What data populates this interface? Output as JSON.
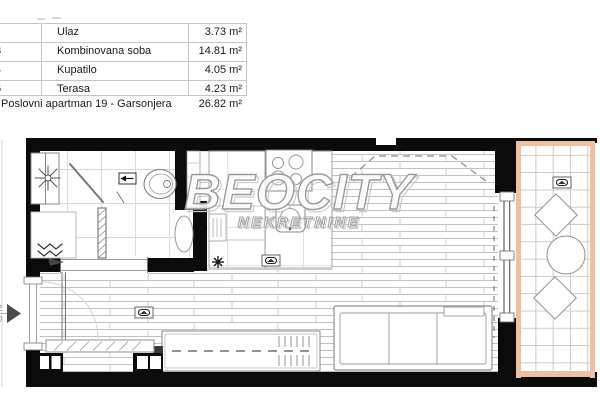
{
  "legend_table": {
    "rows": [
      {
        "num": "",
        "name": "Ulaz",
        "area": "3.73 m²"
      },
      {
        "num": "3",
        "name": "Kombinovana soba",
        "area": "14.81 m²"
      },
      {
        "num": "4",
        "name": "Kupatilo",
        "area": "4.05 m²"
      },
      {
        "num": "5",
        "name": "Terasa",
        "area": "4.23 m²"
      }
    ],
    "total": {
      "name": "Poslovni apartman 19 - Garsonjera",
      "area": "26.82 m²"
    }
  },
  "watermark": {
    "line1": "BEOCITY",
    "line2": "NEKRETNINE"
  },
  "floorplan": {
    "entrance_dimension_fragments": [
      "2",
      "0"
    ],
    "colors": {
      "wall": "#0b0b0b",
      "terrace_border": "#eec2a0",
      "watermark_outline": "#9b9b9b",
      "drawing_line": "#8a8a8a",
      "table_line": "#c6c6c6"
    }
  }
}
